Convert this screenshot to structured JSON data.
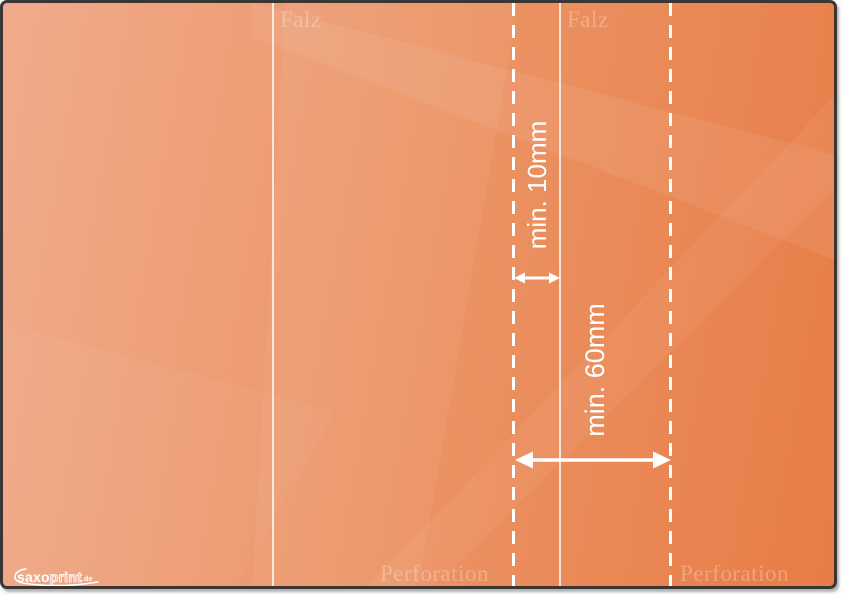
{
  "document": {
    "type": "print-template-guide",
    "fold_lines": [
      {
        "label": "Falz"
      },
      {
        "label": "Falz"
      }
    ],
    "perforation_lines": [
      {
        "label": "Perforation"
      },
      {
        "label": "Perforation"
      }
    ],
    "measurements": {
      "small_gap": "min. 10mm",
      "large_gap": "min. 60mm"
    },
    "logo": {
      "part_bold": "saxo",
      "part_outline": "print",
      "part_tld": ".de"
    },
    "colors": {
      "background_light": "#f1ab8c",
      "background_mid": "#eb9262",
      "background_dark": "#e87c46",
      "line_white": "#ffffff",
      "watermark_white": "rgba(255,255,255,0.28)",
      "frame_border": "#3a3633"
    }
  }
}
